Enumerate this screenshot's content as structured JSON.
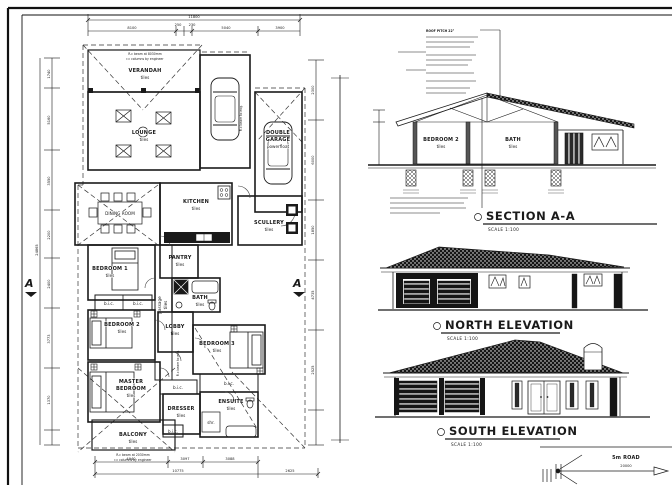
{
  "colors": {
    "ink": "#1a1a1a",
    "paper": "#ffffff"
  },
  "plan": {
    "rooms": {
      "verandah": {
        "name": "VERANDAH",
        "finish": "tiles"
      },
      "lounge": {
        "name": "LOUNGE",
        "finish": "tiles"
      },
      "dining": {
        "name": "DINING ROOM"
      },
      "kitchen": {
        "name": "KITCHEN",
        "finish": "tiles"
      },
      "scullery": {
        "name": "SCULLERY",
        "finish": "tiles"
      },
      "pantry": {
        "name": "PANTRY",
        "finish": "tiles"
      },
      "bedroom1": {
        "name": "BEDROOM 1",
        "finish": "tiles"
      },
      "passage": {
        "name": "passage",
        "finish": "tiles"
      },
      "bath": {
        "name": "BATH",
        "finish": "tiles"
      },
      "bedroom2": {
        "name": "BEDROOM 2",
        "finish": "tiles"
      },
      "lobby": {
        "name": "LOBBY",
        "finish": "tiles"
      },
      "bedroom3": {
        "name": "BEDROOM 3",
        "finish": "tiles"
      },
      "master": {
        "line1": "MASTER",
        "line2": "BEDROOM",
        "finish": "tiles"
      },
      "dresser": {
        "name": "DRESSER",
        "finish": "tiles"
      },
      "ensuite": {
        "name": "ENSUITE",
        "finish": "tiles"
      },
      "balcony": {
        "name": "BALCONY",
        "finish": "tiles"
      },
      "garage": {
        "line1": "DOUBLE",
        "line2": "GARAGE",
        "finish": "powerfloat"
      }
    },
    "labels": {
      "bic": "b.i.c.",
      "shr": "shr."
    },
    "notes": {
      "beam_top_1": "R.c beam at 8030mm",
      "beam_top_2": "r.c columns by engineer",
      "beam_bottom_1": "R.c beam at 2030mm",
      "beam_bottom_2": "r.c columns by engineer",
      "beam_side": "R.c beam to eng."
    },
    "dims": {
      "top_total": "11800",
      "top": [
        "8100",
        "250",
        "230",
        "5040",
        "3900"
      ],
      "bottom": [
        "4940",
        "3097",
        "3088"
      ],
      "bottom_totals": [
        "10775",
        "2625"
      ],
      "left": [
        "1740",
        "5160",
        "3550",
        "2200",
        "2400",
        "3773",
        "1370"
      ],
      "left_total": "24865",
      "right": [
        "2300",
        "6000",
        "1850",
        "4735",
        "2525"
      ]
    },
    "section_marker": "A"
  },
  "section": {
    "title": "SECTION A-A",
    "scale": "SCALE 1:100",
    "roof_note_title": "ROOF PITCH 22°",
    "rooms": {
      "bedroom": {
        "name": "BEDROOM 2",
        "finish": "tiles"
      },
      "bath": {
        "name": "BATH",
        "finish": "tiles"
      }
    }
  },
  "north_elevation": {
    "title": "NORTH ELEVATION",
    "scale": "SCALE 1:100"
  },
  "south_elevation": {
    "title": "SOUTH ELEVATION",
    "scale": "SCALE 1:100"
  },
  "road": {
    "label": "5m ROAD",
    "dim": "20000"
  }
}
